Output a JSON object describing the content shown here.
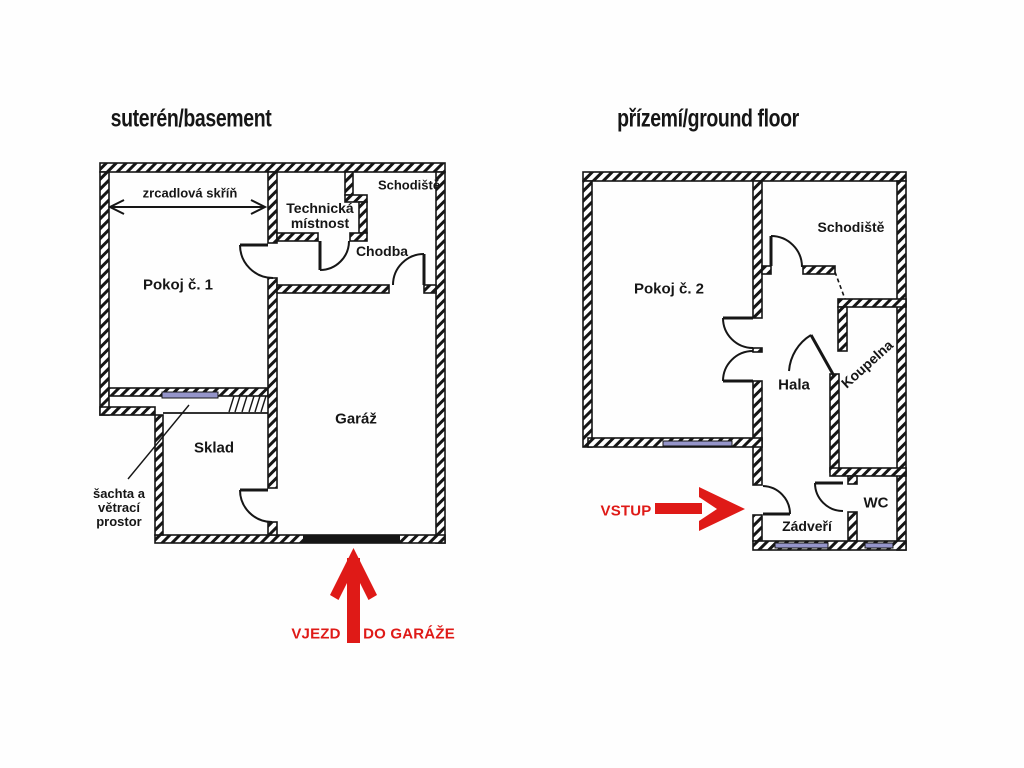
{
  "colors": {
    "wall_line": "#161616",
    "arrow_red": "#df1a17",
    "window_fill": "#9595ca",
    "background": "#ffffff"
  },
  "basement": {
    "title": "suterén/basement",
    "room_pokoj1": "Pokoj č. 1",
    "room_schodiste": "Schodiště",
    "room_technicka_line1": "Technická",
    "room_technicka_line2": "místnost",
    "room_chodba": "Chodba",
    "room_garaz": "Garáž",
    "room_sklad": "Sklad",
    "wardrobe_label": "zrcadlová  skříň",
    "shaft_line1": "šachta a",
    "shaft_line2": "větrací",
    "shaft_line3": "prostor",
    "entrance_label_left": "VJEZD",
    "entrance_label_right": "DO GARÁŽE"
  },
  "ground_floor": {
    "title": "přízemí/ground floor",
    "room_pokoj2": "Pokoj č. 2",
    "room_schodiste": "Schodiště",
    "room_hala": "Hala",
    "room_koupelna": "Koupelna",
    "room_wc": "WC",
    "room_zadveri": "Zádveří",
    "entrance_label": "VSTUP"
  }
}
